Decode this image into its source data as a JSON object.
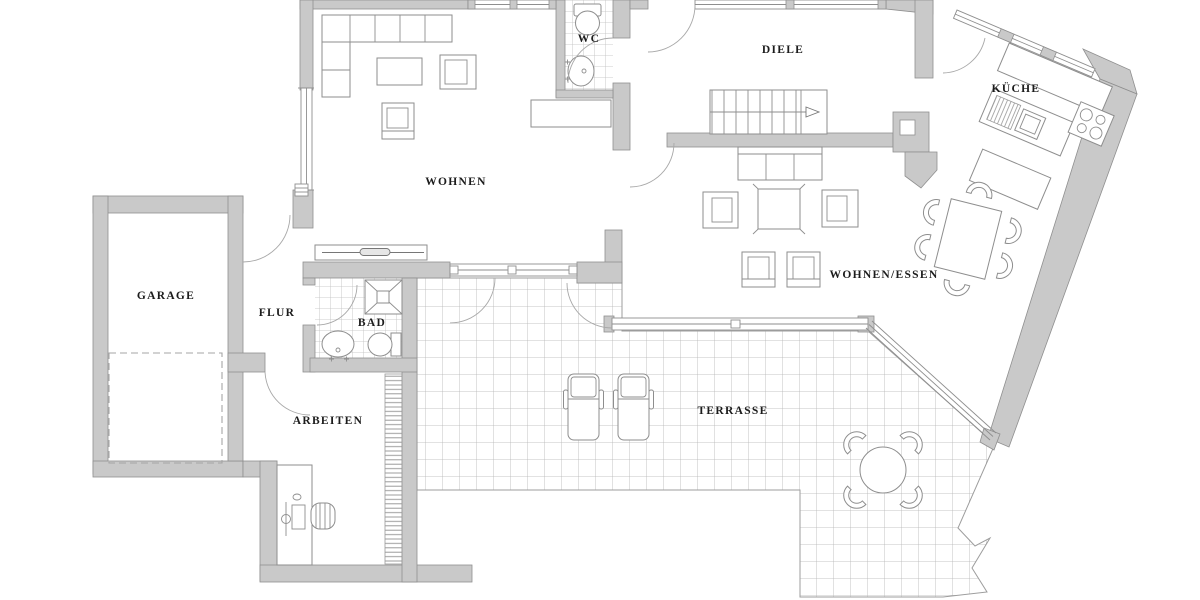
{
  "plan": {
    "title": "Grundriss Erdgeschoss",
    "colors": {
      "wall_fill": "#c9c9c9",
      "wall_stroke": "#8f8f8f",
      "line": "#8e8e8e",
      "tile_line": "#b4b4b4",
      "label": "#1c1c1c",
      "background": "#ffffff"
    },
    "rooms": [
      {
        "id": "wohnen",
        "label": "WOHNEN"
      },
      {
        "id": "wc",
        "label": "WC"
      },
      {
        "id": "diele",
        "label": "DIELE"
      },
      {
        "id": "kueche",
        "label": "KÜCHE"
      },
      {
        "id": "wohnen-essen",
        "label": "WOHNEN/ESSEN"
      },
      {
        "id": "garage",
        "label": "GARAGE"
      },
      {
        "id": "flur",
        "label": "FLUR"
      },
      {
        "id": "bad",
        "label": "BAD"
      },
      {
        "id": "arbeiten",
        "label": "ARBEITEN"
      },
      {
        "id": "terrasse",
        "label": "TERRASSE"
      }
    ],
    "furniture_icons": [
      "corner-sofa-icon",
      "coffee-table-icon",
      "armchair-icon",
      "sideboard-icon",
      "toilet-icon",
      "washbasin-icon",
      "stair-icon",
      "sofa-icon",
      "square-table-icon",
      "dining-table-icon",
      "chair-icon",
      "kitchen-counter-icon",
      "sink-icon",
      "stove-icon",
      "kitchen-island-icon",
      "shower-icon",
      "car-space-icon",
      "desk-icon",
      "office-chair-icon",
      "shelf-icon",
      "sun-lounger-icon",
      "round-table-icon"
    ]
  }
}
